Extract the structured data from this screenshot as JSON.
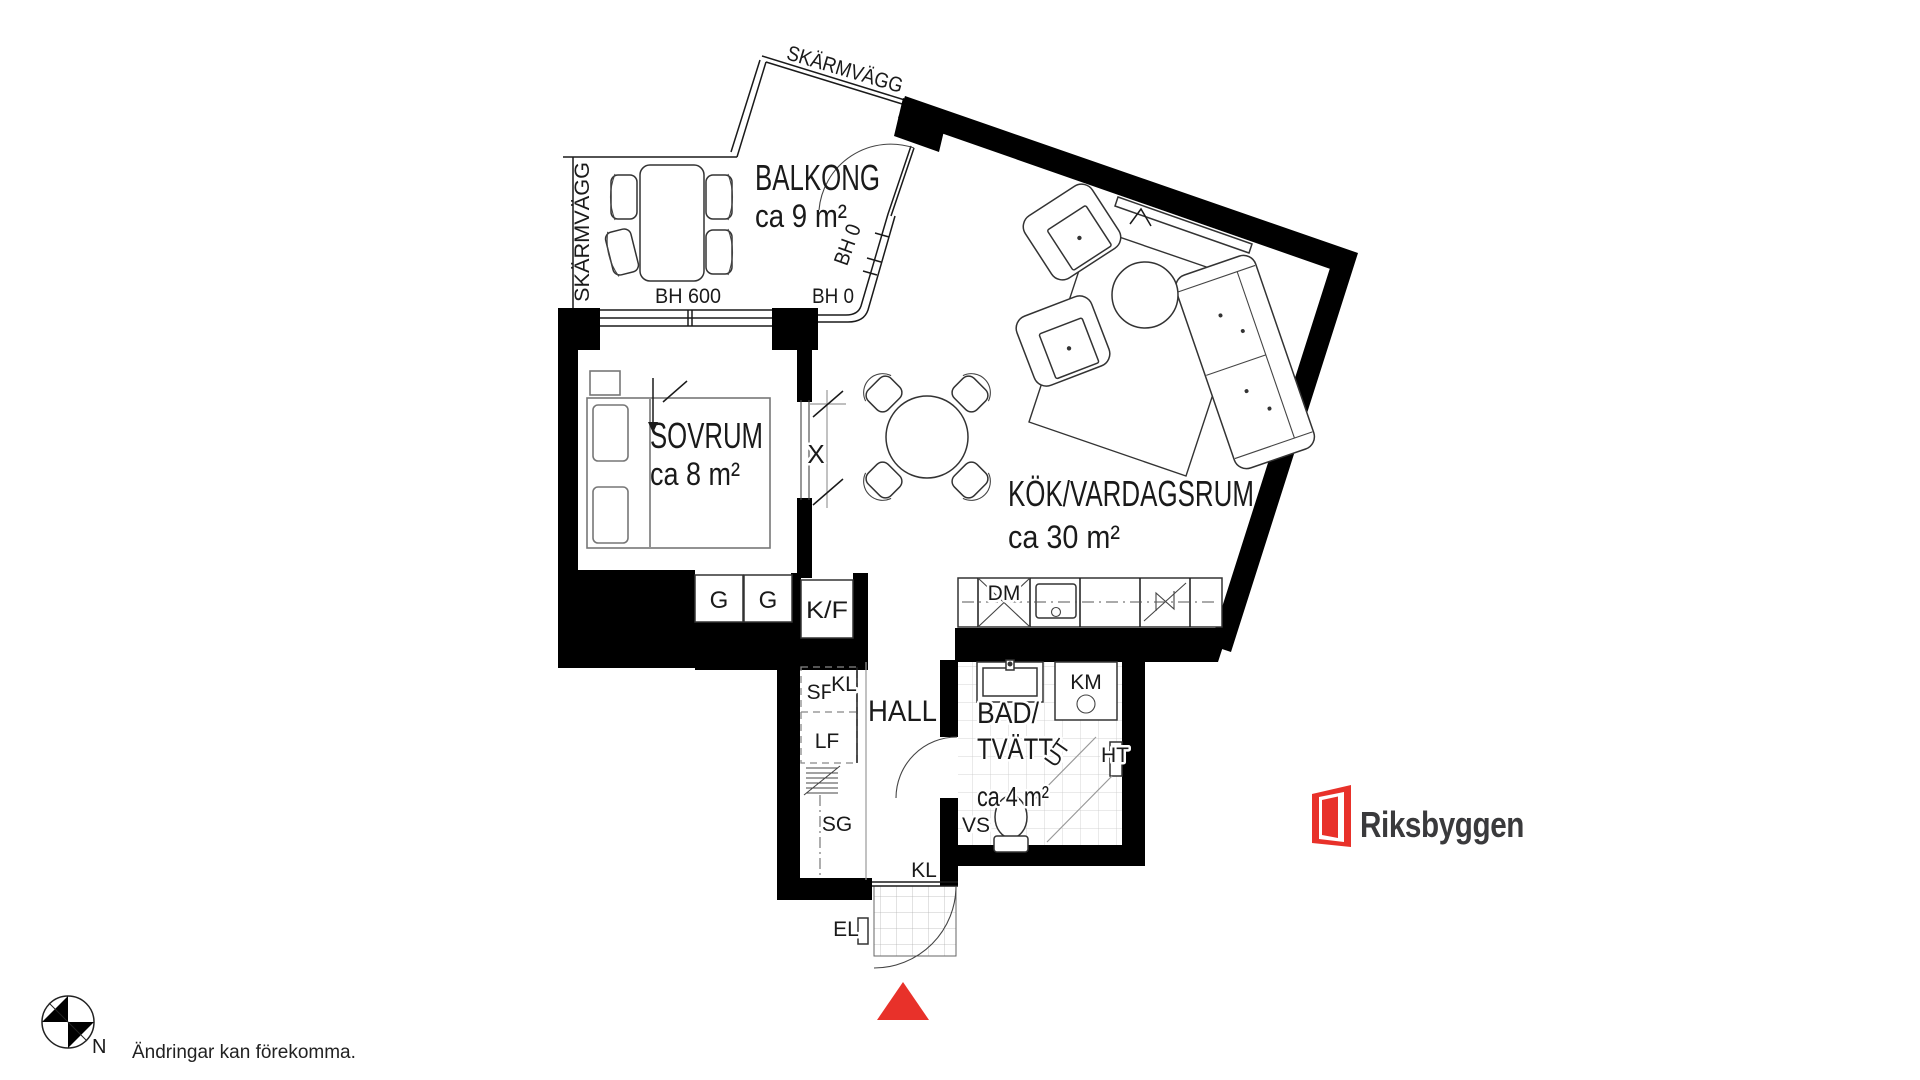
{
  "colors": {
    "accent_red": "#e8312a",
    "wall_black": "#000000"
  },
  "balcony": {
    "label": "BALKONG",
    "area": "ca 9 m²",
    "screen_wall_left": "SKÄRMVÄGG",
    "screen_wall_top": "SKÄRMVÄGG",
    "sill_height_table": "BH 600",
    "sill_height_front": "BH 0",
    "sill_height_door": "BH 0"
  },
  "bedroom": {
    "label": "SOVRUM",
    "area": "ca 8 m²",
    "sliding_door_marker": "X"
  },
  "living_room": {
    "label": "KÖK/VARDAGSRUM",
    "area": "ca 30 m²"
  },
  "kitchen": {
    "wardrobe_1": "G",
    "wardrobe_2": "G",
    "fridge_freezer": "K/F",
    "dishwasher": "DM"
  },
  "hall": {
    "label": "HALL",
    "sf": "SF",
    "kl_top": "KL",
    "lf": "LF",
    "sg": "SG",
    "kl_bottom": "KL",
    "el": "EL"
  },
  "bathroom": {
    "label_line1": "BAD/",
    "label_line2": "TVÄTT",
    "area": "ca 4 m²",
    "km": "KM",
    "ht": "HT",
    "vs": "VS",
    "ut": "UT"
  },
  "compass": {
    "north": "N"
  },
  "footer": {
    "disclaimer": "Ändringar kan förekomma."
  },
  "brand": {
    "name": "Riksbyggen"
  }
}
